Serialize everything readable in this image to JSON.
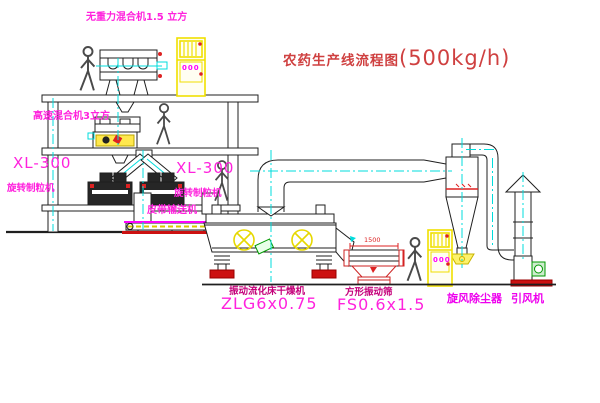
{
  "title": {
    "name": "农药生产线流程图",
    "capacity": "(500kg/h)"
  },
  "equipment_labels": {
    "gravity_free_mixer": "无重力混合机1.5 立方",
    "high_speed_mixer": "高速混合机3立方",
    "granulator_model": "XL-300",
    "granulator_name": "旋转制粒机",
    "belt_conveyor": "皮带输送机",
    "fluid_bed_dryer_name": "振动流化床干燥机",
    "fluid_bed_dryer_model": "ZLG6x0.75",
    "vibrating_screen_name": "方形振动筛",
    "vibrating_screen_model": "FS0.6x1.5",
    "cyclone": "旋风除尘器",
    "induced_draft_fan": "引风机"
  },
  "dimensions": {
    "screen_length": "1500"
  },
  "cabinet_indicator": "000",
  "colors": {
    "label_magenta": "#ff22dd",
    "label_dark_magenta": "#c4007a",
    "title_red": "#cf4040",
    "line_black": "#1f1f1f",
    "centerline_cyan": "#00dcdc",
    "machine_yellow": "#f0df00",
    "accent_red": "#cc1111",
    "motor_green": "#009900"
  }
}
